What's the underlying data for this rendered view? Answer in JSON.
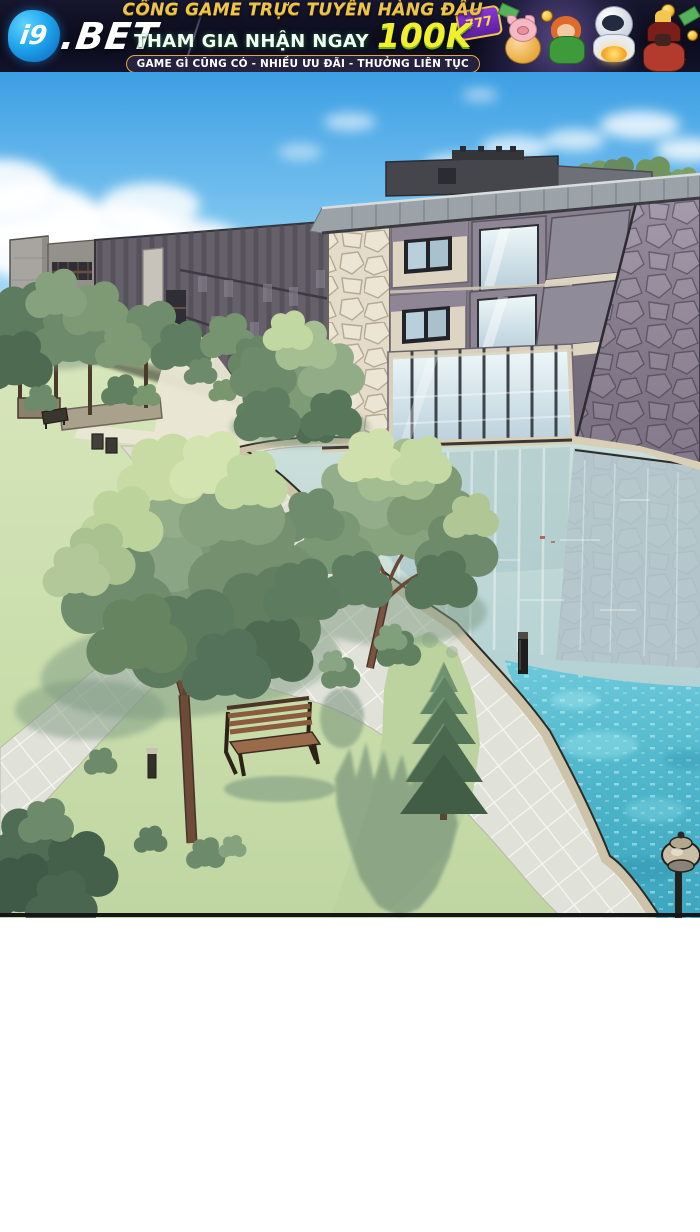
{
  "banner": {
    "logo": {
      "prefix": "i9",
      "suffix": ".BET"
    },
    "headline": "CỔNG GAME TRỰC TUYẾN HÀNG ĐẦU",
    "subline": "THAM GIA NHẬN NGAY",
    "amount": "100K",
    "pill": "GAME GÌ CŨNG CÓ - NHIỀU ƯU ĐÃI - THƯỞNG LIÊN TỤC",
    "slot_badge": "777",
    "colors": {
      "background": "#0c0c1c",
      "gold": "#edc44c",
      "amount_yellow": "#f2ef2e",
      "pill_border": "#e2a83e",
      "logo_blue": "#1fa6ee"
    }
  },
  "scene": {
    "description": "Manhwa panel: aerial view of a campus of gray stone buildings beside a large reflective pool, with lawns, tiled walkways, trees, a wooden bench and garden lamps under a blue sky.",
    "objects": [
      "sky with clouds",
      "three-story building with stone pillars and glass curtain wall",
      "dark slatted left wing",
      "stone tower",
      "rooftop penthouse",
      "flagstone side wall",
      "reflective pool water",
      "turquoise pool water",
      "tiled walkway",
      "lawn",
      "large deciduous trees",
      "conifer tree",
      "wooden bench",
      "pergola structures",
      "trash bins",
      "light bollards",
      "garden lamp post"
    ],
    "colors": {
      "sky_top": "#3d9fe4",
      "sky_horizon": "#e8f6fb",
      "water_reflective": "#c2d8d6",
      "water_turquoise": "#4db4c9",
      "grass": "#c9dcae",
      "deck_tile": "#e0e1d8",
      "stone_cream": "#e4dcc9",
      "stone_mauve": "#978c9e",
      "facade": "#8a8190",
      "roof": "#9ba3a9"
    }
  }
}
